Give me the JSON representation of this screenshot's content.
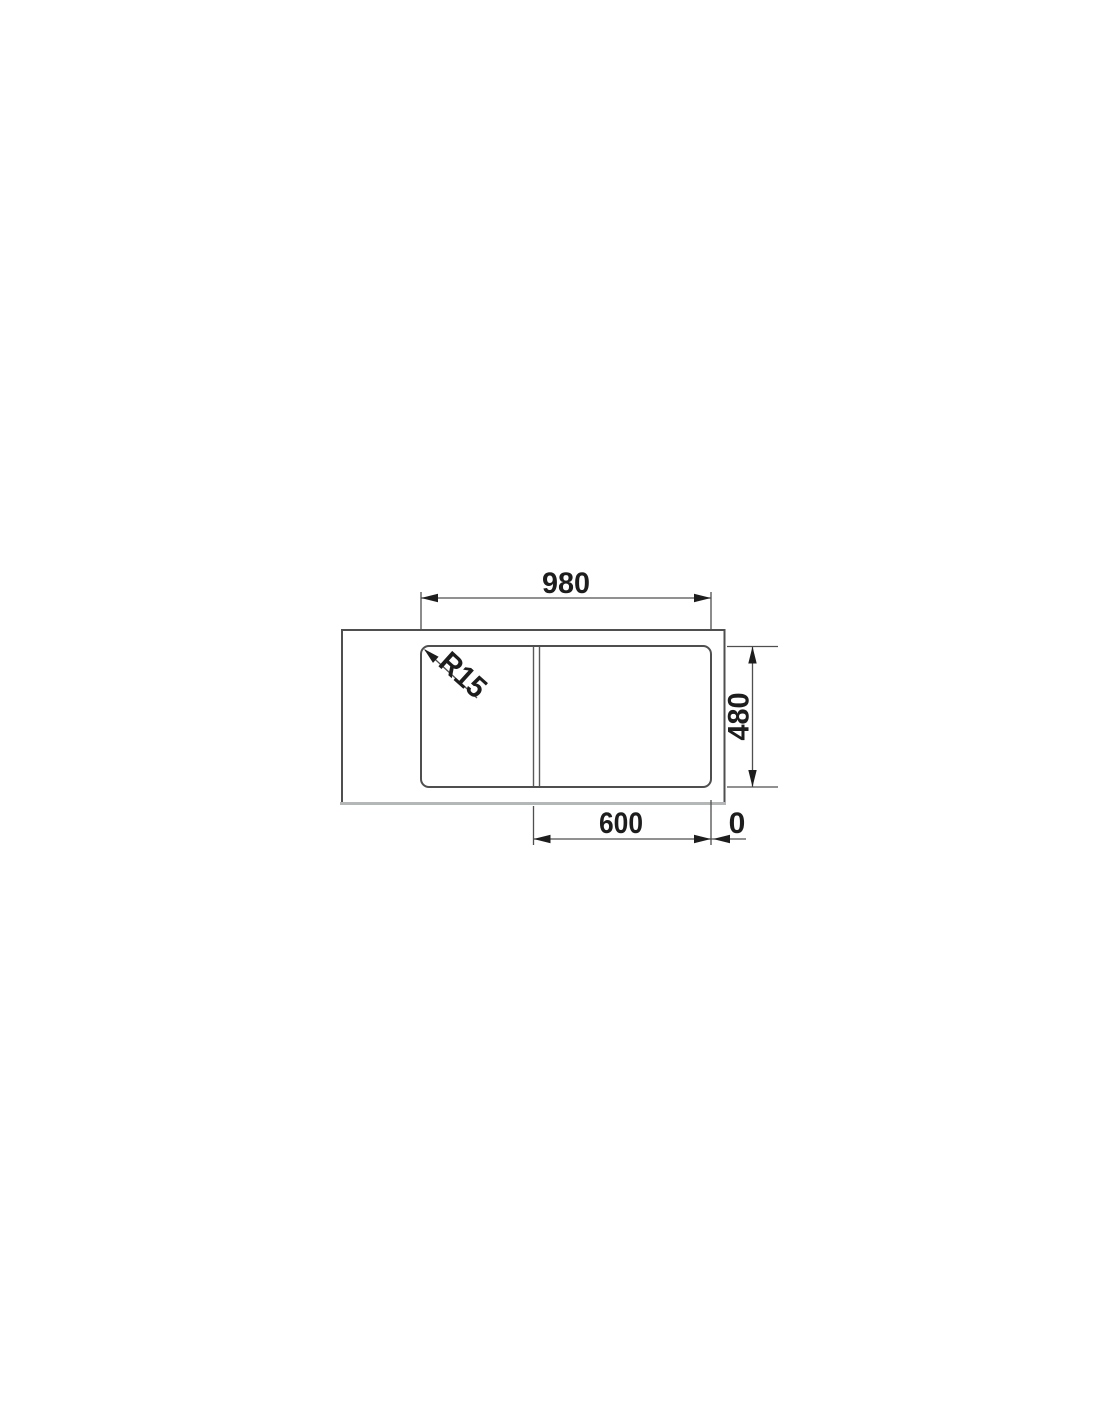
{
  "page": {
    "background": "#ffffff"
  },
  "diagram": {
    "description": "Technical top-view dimension drawing of an inset kitchen sink with drainer section and bowl",
    "labels": {
      "top_width": "980",
      "right_depth": "480",
      "bottom_width": "600",
      "bottom_offset": "0",
      "corner_radius": "R15"
    },
    "colors": {
      "object_line": "#4f4f4f",
      "light_edge": "#b4b7b7",
      "dimension_line": "#4f4f4f",
      "text": "#1d1d1d"
    }
  }
}
